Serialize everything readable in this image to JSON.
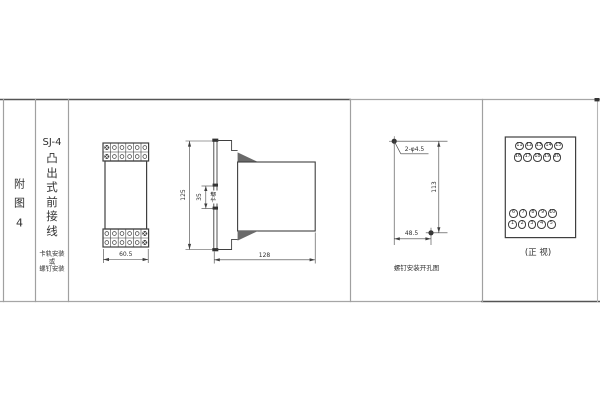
{
  "colors": {
    "line": "#3f3f3f",
    "frame": "#a0a0a0"
  },
  "title_block": {
    "figure_label_chars": [
      "附",
      "图",
      "4"
    ],
    "model": "SJ-4",
    "type_vertical": "凸出式前接线",
    "mounting_note": "卡轨安装\n或\n螺钉安装"
  },
  "front_dimension_view": {
    "width_dim": "60.5"
  },
  "side_view": {
    "height_dim": "125",
    "slot_dim": "35",
    "slot_label": "卡槽",
    "depth_dim": "128"
  },
  "drill_view": {
    "hole_spec": "2-φ4.5",
    "vertical_dim": "113",
    "horizontal_dim": "48.5",
    "caption": "螺钉安装开孔图"
  },
  "front_view": {
    "caption": "(正 视)",
    "terminal_rows": [
      {
        "numbers": [
          "11",
          "12",
          "13",
          "14",
          "15"
        ]
      },
      {
        "numbers": [
          "16",
          "17",
          "18",
          "19",
          "20"
        ]
      },
      {
        "numbers": [
          "6",
          "7",
          "8",
          "9",
          "10"
        ]
      },
      {
        "numbers": [
          "1",
          "2",
          "3",
          "4",
          "5"
        ]
      }
    ]
  }
}
